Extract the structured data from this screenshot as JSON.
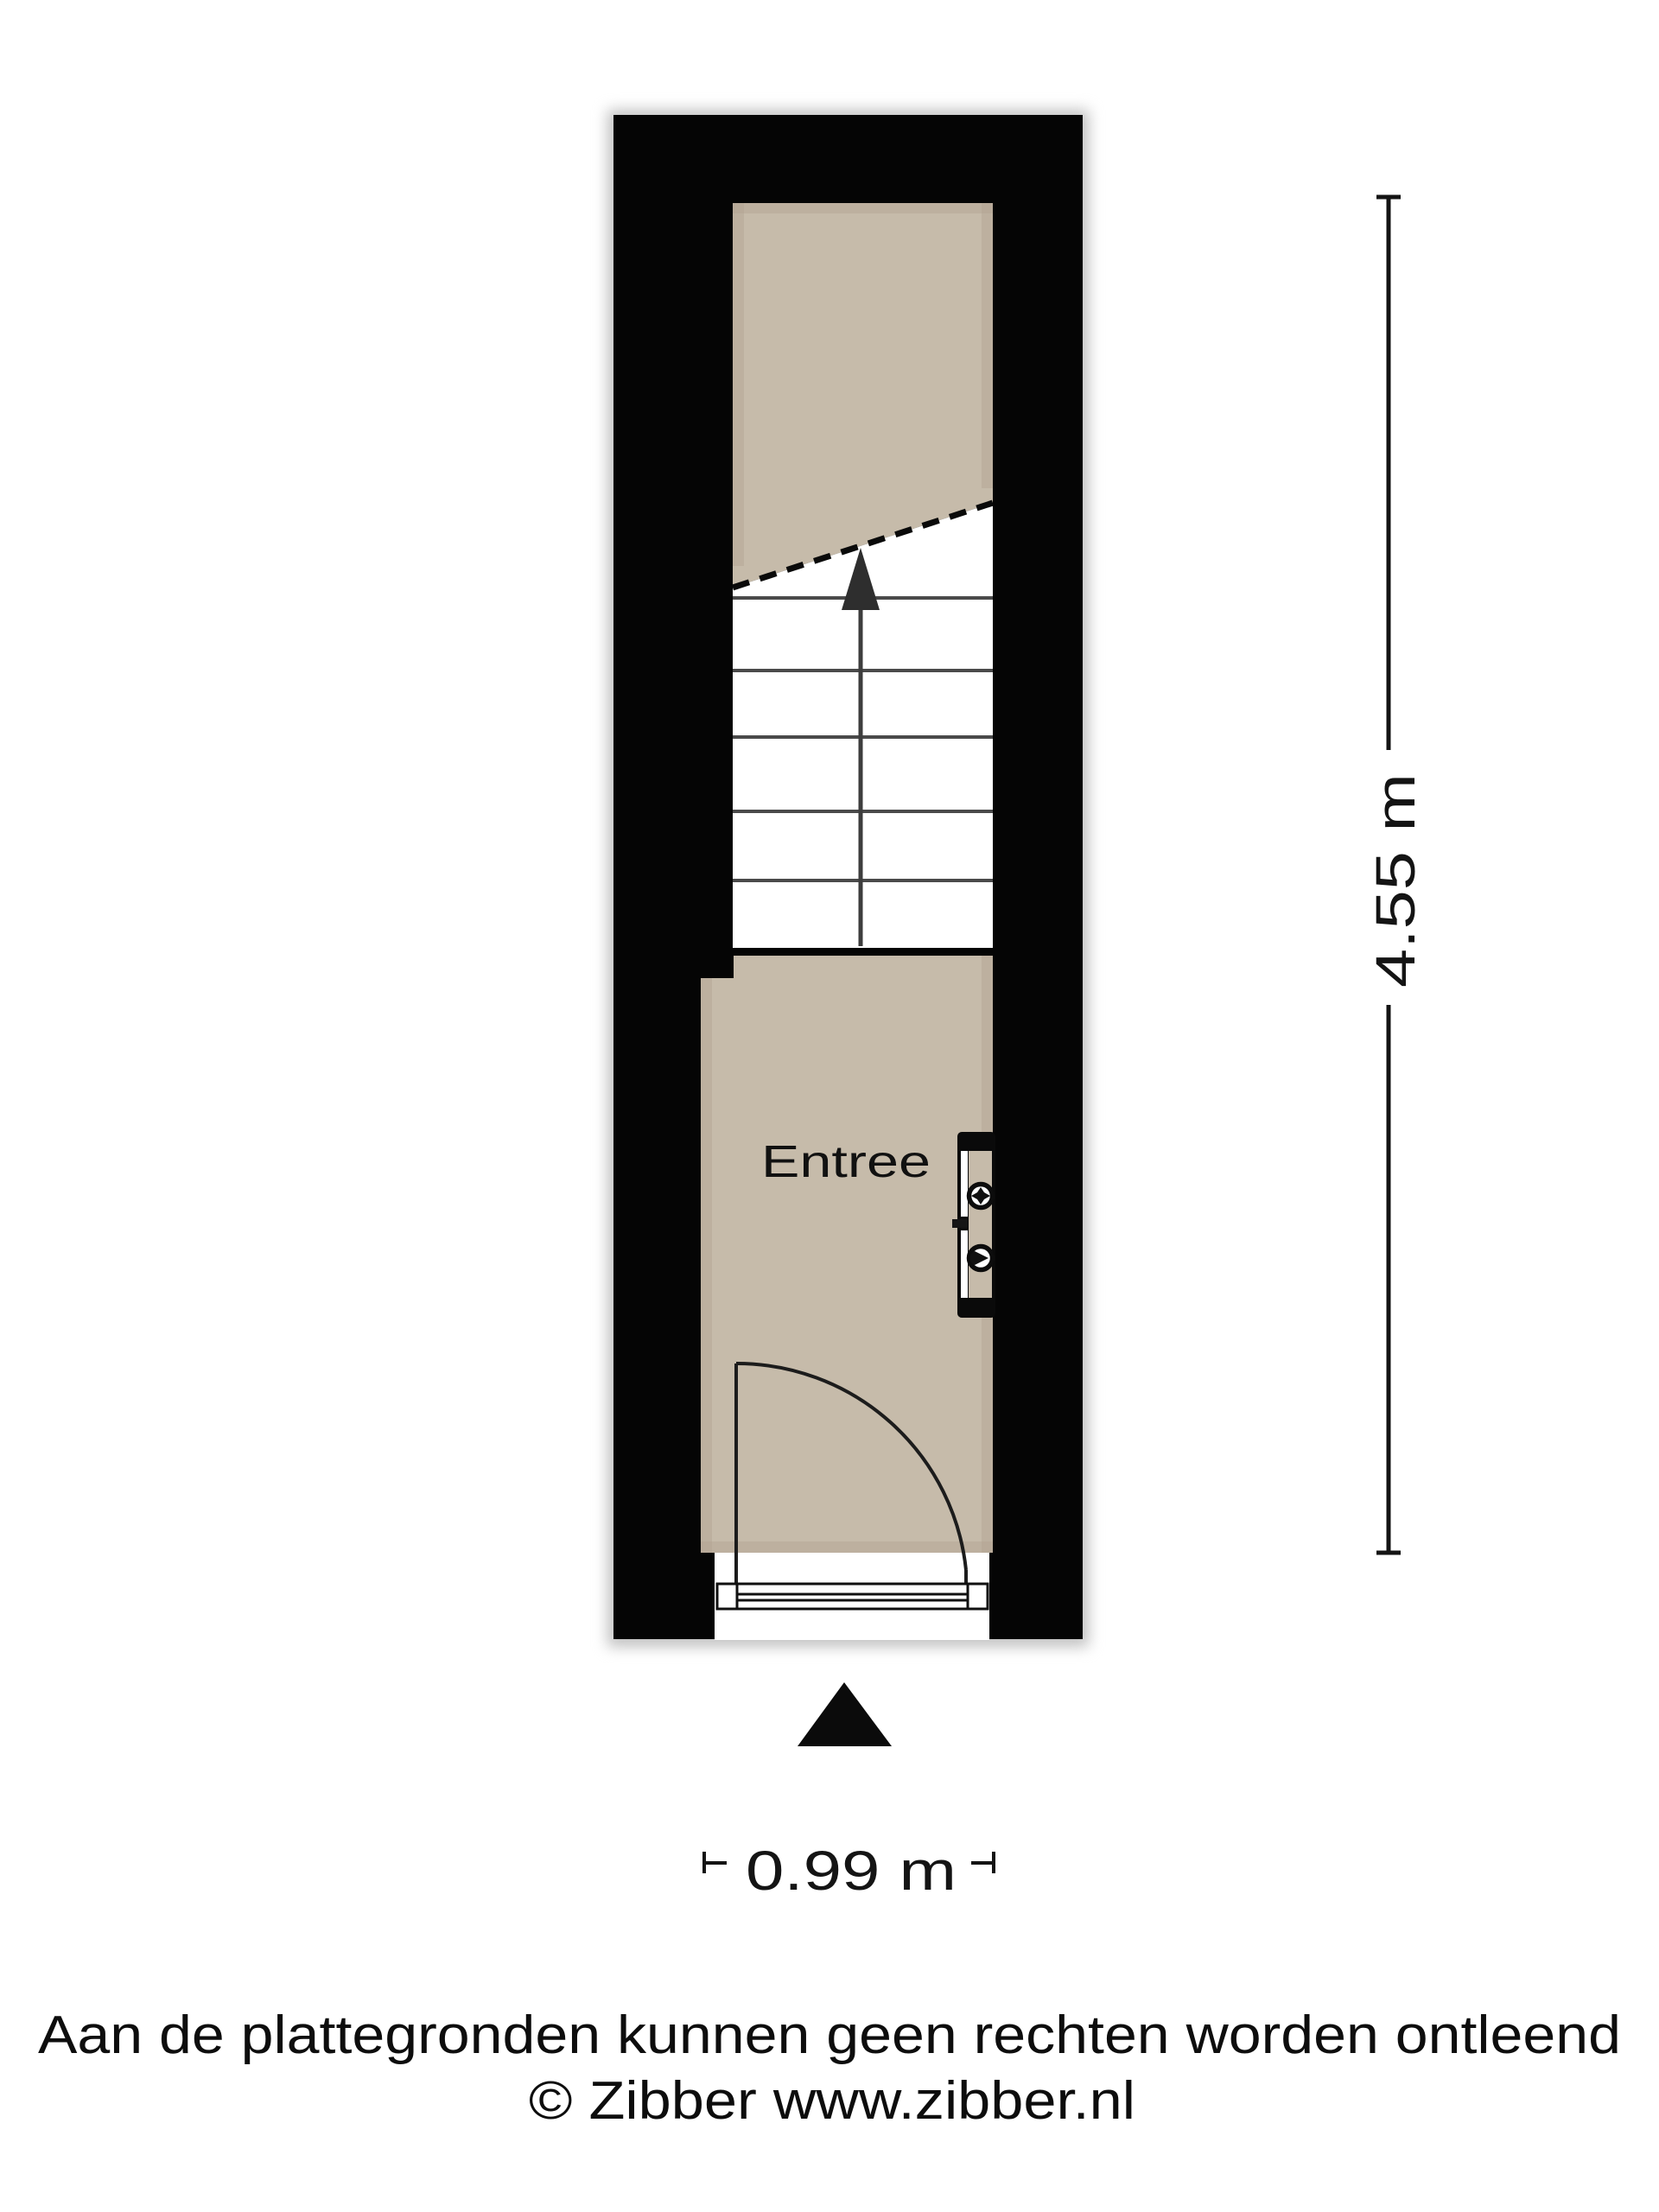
{
  "plan": {
    "room_label": "Entree",
    "dimensions": {
      "vertical": "4.55 m",
      "horizontal": "0.99 m"
    },
    "colors": {
      "wall": "#050505",
      "floor": "#c6bbaa",
      "stair_tread": "#4a4a4a",
      "dimension_text": "#141414",
      "paper": "#ffffff"
    }
  },
  "footer": {
    "disclaimer": "Aan de plattegronden kunnen geen rechten worden ontleend",
    "copyright": "© Zibber www.zibber.nl"
  },
  "icons": {
    "meter_box": "meter-box-icon",
    "stair_arrow": "stair-direction-arrow-icon",
    "entrance_marker": "entrance-arrow-icon"
  }
}
